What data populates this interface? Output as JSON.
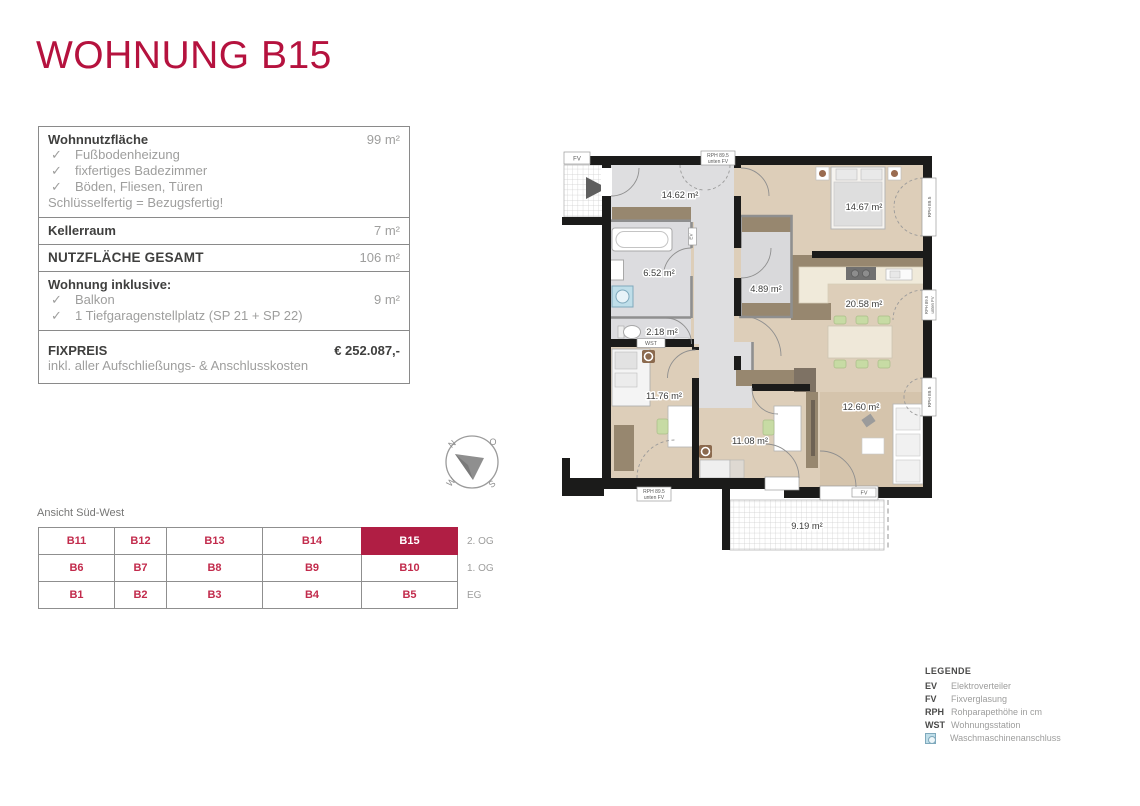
{
  "title": "WOHNUNG B15",
  "colors": {
    "brand_red": "#B5123E",
    "selected_unit_bg": "#B01E44",
    "floor_beige": "#DDCEB9",
    "floor_gray": "#DCDCDF",
    "furniture_brown": "#97876F",
    "wall_black": "#1B1B1A",
    "washing_icon_blue": "#BFDEE9"
  },
  "info": {
    "check_glyph": "✓",
    "rows": [
      {
        "label": "Wohnnutzfläche",
        "value": "99 m²",
        "checks": [
          "Fußbodenheizung",
          "fixfertiges Badezimmer",
          "Böden, Fliesen, Türen"
        ],
        "note": "Schlüsselfertig = Bezugsfertig!"
      },
      {
        "label": "Kellerraum",
        "value": "7 m²"
      },
      {
        "label": "NUTZFLÄCHE GESAMT",
        "value": "106 m²"
      },
      {
        "label": "Wohnung inklusive:",
        "items": [
          {
            "text": "Balkon",
            "value": "9 m²"
          },
          {
            "text": "1 Tiefgaragenstellplatz (SP 21 + SP 22)",
            "value": ""
          }
        ]
      },
      {
        "label": "FIXPREIS",
        "value": "€ 252.087,-",
        "note": "inkl. aller Aufschließungs- & Anschlusskosten"
      }
    ]
  },
  "plan": {
    "rooms": [
      {
        "name": "hallway",
        "area": "14.62 m²"
      },
      {
        "name": "bathroom",
        "area": "6.52 m²"
      },
      {
        "name": "wc",
        "area": "2.18 m²"
      },
      {
        "name": "storage",
        "area": "4.89 m²"
      },
      {
        "name": "bedroom",
        "area": "14.67 m²"
      },
      {
        "name": "living-kitchen",
        "area": "20.58 m²"
      },
      {
        "name": "child-room-west",
        "area": "11.76 m²"
      },
      {
        "name": "child-room-middle",
        "area": "11.08 m²"
      },
      {
        "name": "lounge",
        "area": "12.60 m²"
      },
      {
        "name": "balcony",
        "area": "9.19 m²"
      }
    ],
    "annotations": {
      "fv": "FV",
      "rph": "RPH 89.5",
      "unten_fv": "unten FV",
      "wst": "WST",
      "ev": "EV"
    }
  },
  "compass": {
    "n": "N",
    "o": "O",
    "s": "S",
    "w": "W"
  },
  "units": {
    "caption": "Ansicht Süd-West",
    "selected": "B15",
    "rows": [
      {
        "cells": [
          "B11",
          "B12",
          "B13",
          "B14",
          "B15"
        ],
        "floor": "2. OG"
      },
      {
        "cells": [
          "B6",
          "B7",
          "B8",
          "B9",
          "B10"
        ],
        "floor": "1. OG"
      },
      {
        "cells": [
          "B1",
          "B2",
          "B3",
          "B4",
          "B5"
        ],
        "floor": "EG"
      }
    ]
  },
  "legend": {
    "title": "LEGENDE",
    "entries": [
      {
        "abbr": "EV",
        "desc": "Elektroverteiler"
      },
      {
        "abbr": "FV",
        "desc": "Fixverglasung"
      },
      {
        "abbr": "RPH",
        "desc": "Rohparapethöhe in cm"
      },
      {
        "abbr": "WST",
        "desc": "Wohnungsstation"
      },
      {
        "abbr": "",
        "desc": "Waschmaschinenanschluss"
      }
    ]
  }
}
